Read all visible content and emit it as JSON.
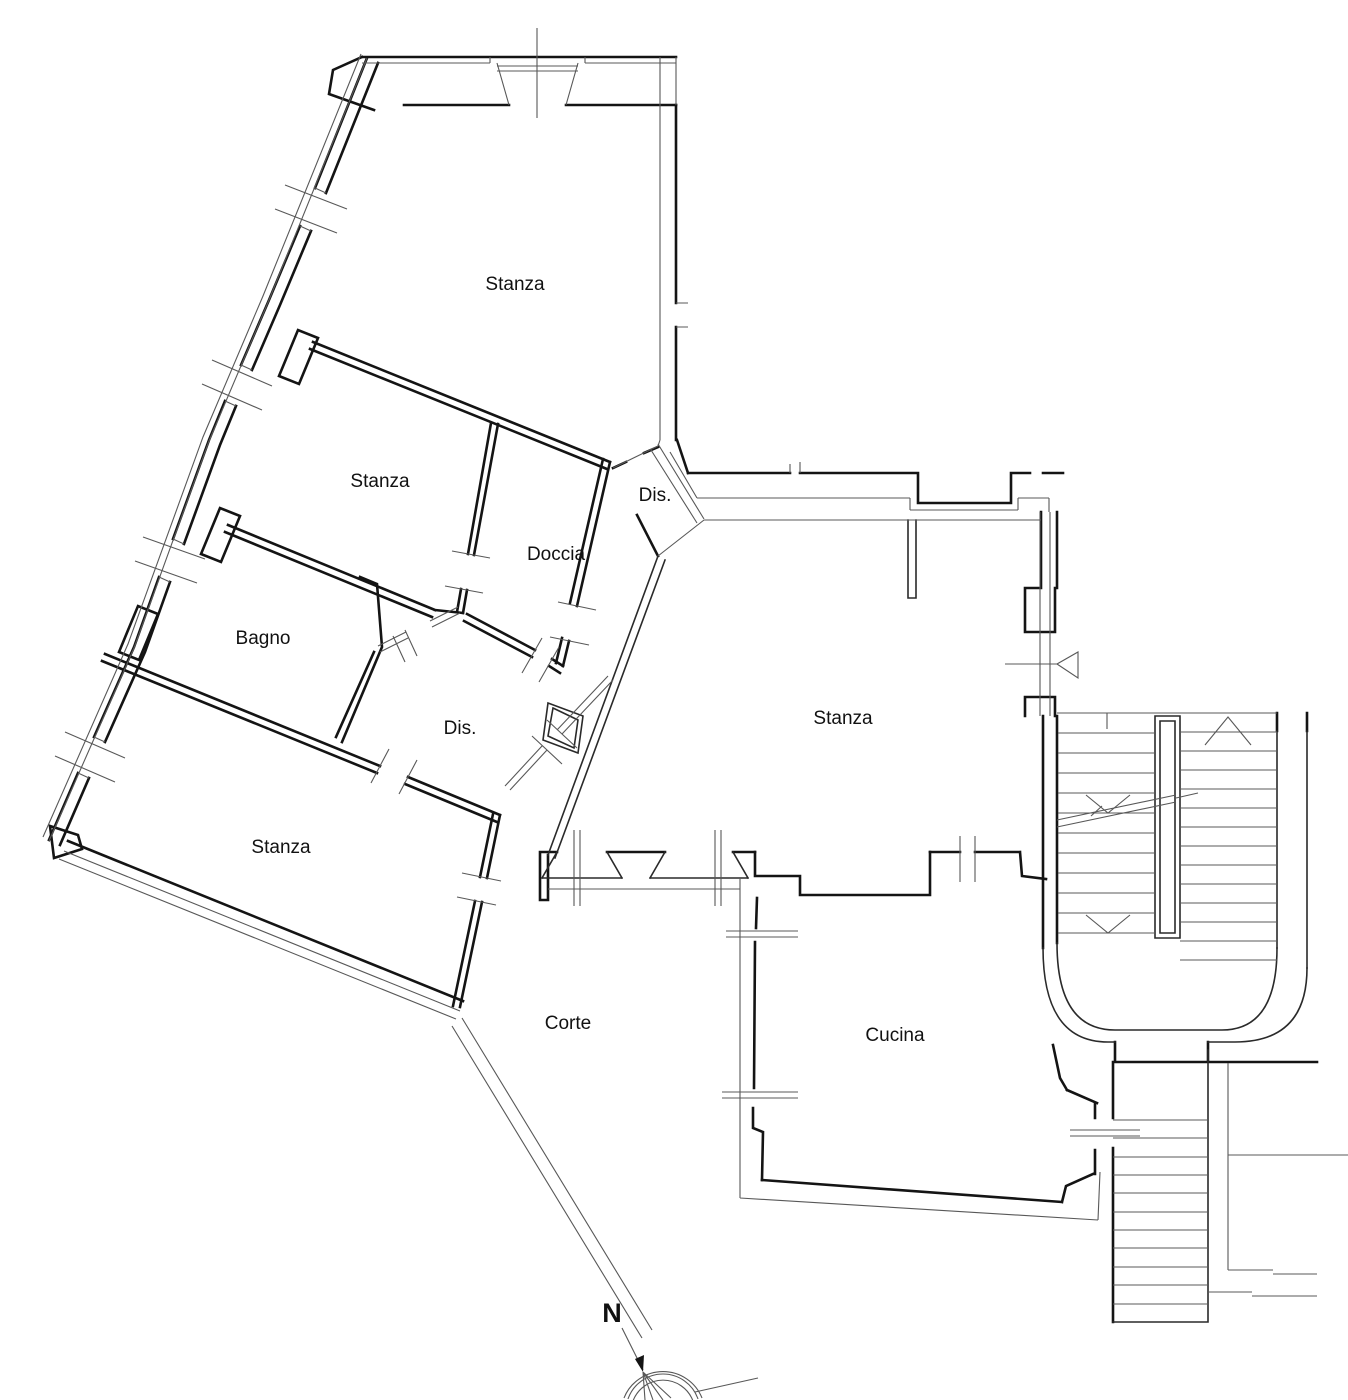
{
  "plan": {
    "title": "floor-plan",
    "rooms": [
      {
        "id": "stanza-top",
        "label": "Stanza"
      },
      {
        "id": "stanza-mid",
        "label": "Stanza"
      },
      {
        "id": "doccia",
        "label": "Doccia"
      },
      {
        "id": "bagno",
        "label": "Bagno"
      },
      {
        "id": "dis-wing",
        "label": "Dis."
      },
      {
        "id": "stanza-sw",
        "label": "Stanza"
      },
      {
        "id": "dis-vestibule",
        "label": "Dis."
      },
      {
        "id": "stanza-right",
        "label": "Stanza"
      },
      {
        "id": "corte",
        "label": "Corte"
      },
      {
        "id": "cucina",
        "label": "Cucina"
      }
    ],
    "compass": {
      "north_label": "N"
    },
    "colors": {
      "wall": "#141414",
      "thin_line": "#585858",
      "background": "#ffffff"
    }
  }
}
